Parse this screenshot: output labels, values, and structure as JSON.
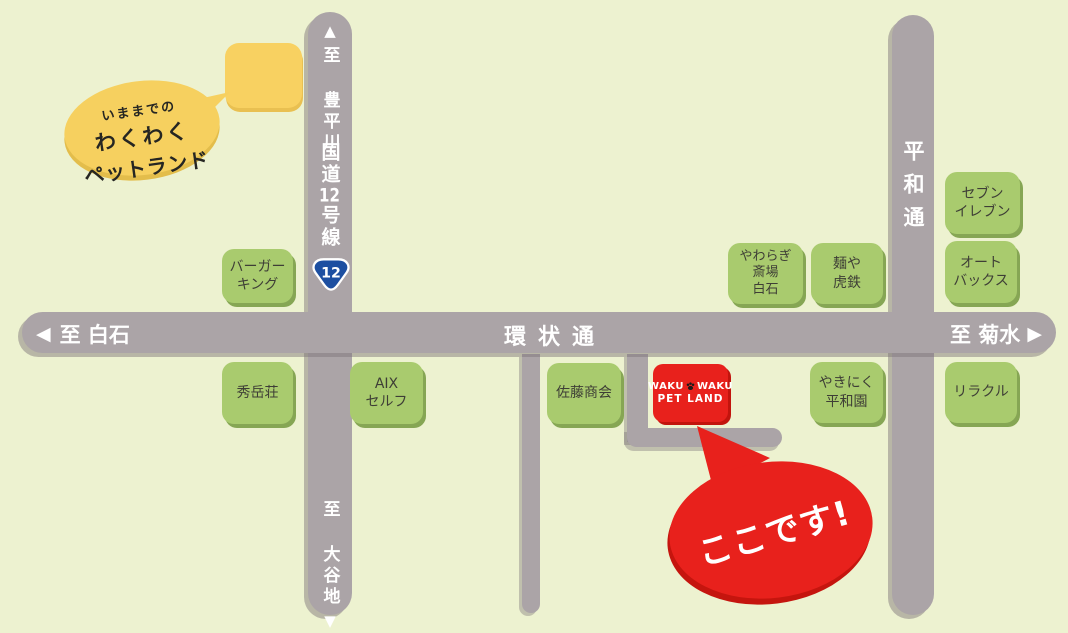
{
  "map": {
    "bg_color": "#edf2d0",
    "road_color": "#aba4a7",
    "building_color": "#a9cb6e",
    "store_red": "#e8211c",
    "highlight_yellow": "#f6d05f",
    "route_badge_blue": "#1d4fa1"
  },
  "old_location_balloon": {
    "lines": [
      "いままでの",
      "わくわく",
      "ペットランド"
    ]
  },
  "roads": {
    "route12": {
      "arrow_up": "▲",
      "to_top": "至 豊平川",
      "name_pre": "国道",
      "name_num": "12",
      "name_post": "号線",
      "badge_number": "12",
      "to_bottom": "至 大谷地",
      "arrow_down": "▼"
    },
    "kanjo": {
      "arrow_left": "◀",
      "to_left": "至 白石",
      "name": "環状通",
      "to_right": "至 菊水",
      "arrow_right": "▶"
    },
    "heiwa": {
      "name": "平和通"
    }
  },
  "buildings": {
    "burger_king": {
      "lines": [
        "バーガー",
        "キング"
      ]
    },
    "shugakuso": {
      "lines": [
        "秀岳荘"
      ]
    },
    "aix_self": {
      "lines": [
        "AIX",
        "セルフ"
      ]
    },
    "sato_shokai": {
      "lines": [
        "佐藤商会"
      ]
    },
    "yawaragi_saijo_shiroishi": {
      "lines": [
        "やわらぎ",
        "斎場",
        "白石"
      ]
    },
    "menya_kotetsu": {
      "lines": [
        "麺や",
        "虎鉄"
      ]
    },
    "seven_eleven": {
      "lines": [
        "セブン",
        "イレブン"
      ]
    },
    "autobacs": {
      "lines": [
        "オート",
        "バックス"
      ]
    },
    "yakiniku_heiwaen": {
      "lines": [
        "やきにく",
        "平和園"
      ]
    },
    "riracle": {
      "lines": [
        "リラクル"
      ]
    }
  },
  "store": {
    "name_word1": "WAKU",
    "name_word2": "WAKU",
    "name_line2": "PET LAND"
  },
  "here_callout": {
    "text": "ここです!"
  }
}
